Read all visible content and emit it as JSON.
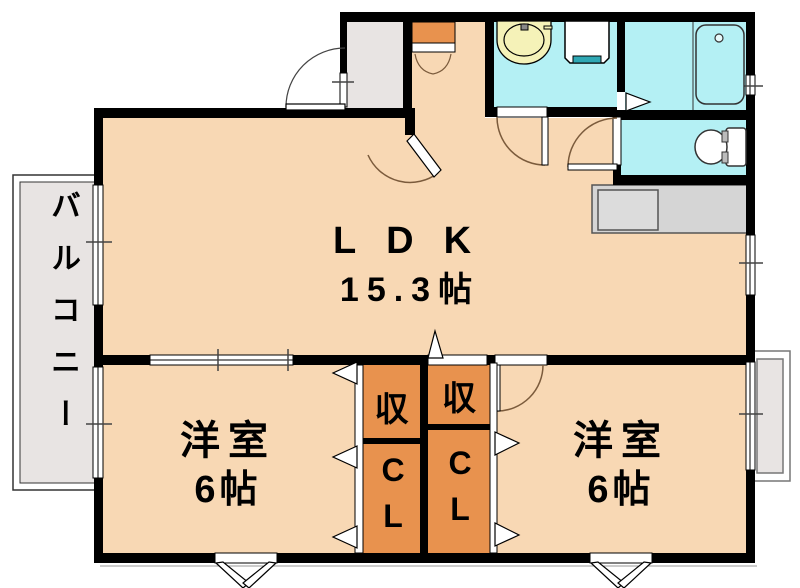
{
  "plan": {
    "rooms": {
      "ldk": {
        "label": "LDK",
        "area": "15.3帖"
      },
      "bedroom_left": {
        "label": "洋室",
        "area": "6帖"
      },
      "bedroom_right": {
        "label": "洋室",
        "area": "6帖"
      },
      "storage_left": {
        "label": "収"
      },
      "storage_right": {
        "label": "収"
      },
      "closet_left": {
        "label": "CL"
      },
      "closet_right": {
        "label": "CL"
      },
      "balcony": {
        "label": "バルコニー"
      }
    },
    "fixtures": [
      "entrance-door",
      "shoe-cabinet",
      "washbasin",
      "washing-machine-pan",
      "bathtub",
      "toilet",
      "kitchen-counter",
      "bay-window-left",
      "bay-window-right"
    ],
    "colors": {
      "floor_peach": "#F8D8B4",
      "storage_orange": "#E8924E",
      "wet_area_cyan": "#B4F0F4",
      "balcony_gray": "#E8E4E3",
      "counter_gray": "#D5D5D5",
      "basin_cream": "#F5F2B8",
      "accent_teal": "#2FA8B4",
      "wall_black": "#000000",
      "door_arc_brown": "#7B5B3C"
    }
  }
}
